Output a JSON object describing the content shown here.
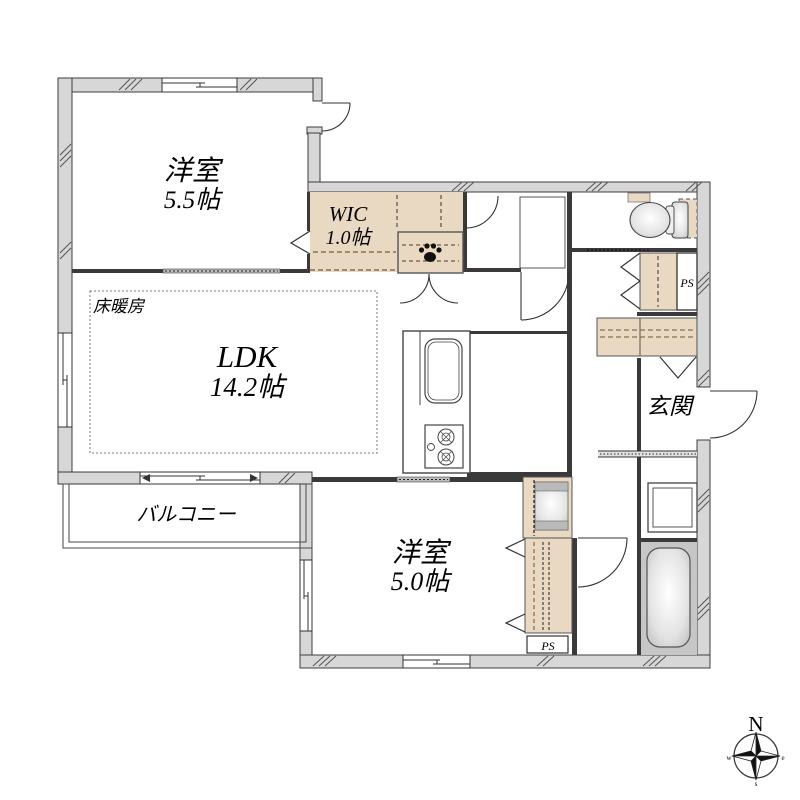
{
  "plan_title": "2LDK apartment floor plan",
  "rooms": {
    "western_room_a": {
      "label": "洋室",
      "area": "5.5帖"
    },
    "wic": {
      "label": "WIC",
      "area": "1.0帖"
    },
    "ldk": {
      "label": "LDK",
      "area": "14.2帖"
    },
    "floor_heating": {
      "label": "床暖房"
    },
    "balcony": {
      "label": "バルコニー"
    },
    "western_room_b": {
      "label": "洋室",
      "area": "5.0帖"
    },
    "entrance": {
      "label": "玄関"
    },
    "pipe_space_right": {
      "label": "PS"
    },
    "pipe_space_bottom": {
      "label": "PS"
    }
  },
  "compass": {
    "north": "N",
    "south": "s",
    "east": "e",
    "west": "w"
  },
  "colors": {
    "wall_fill": "#d7d7d7",
    "wall_stroke": "#3c3c3c",
    "closet_fill": "#ead9c2",
    "closet_dash": "#8a6f4d",
    "bath_floor": "#c6c6c6",
    "slider_band": "#bdbdbd",
    "line": "#333333"
  }
}
